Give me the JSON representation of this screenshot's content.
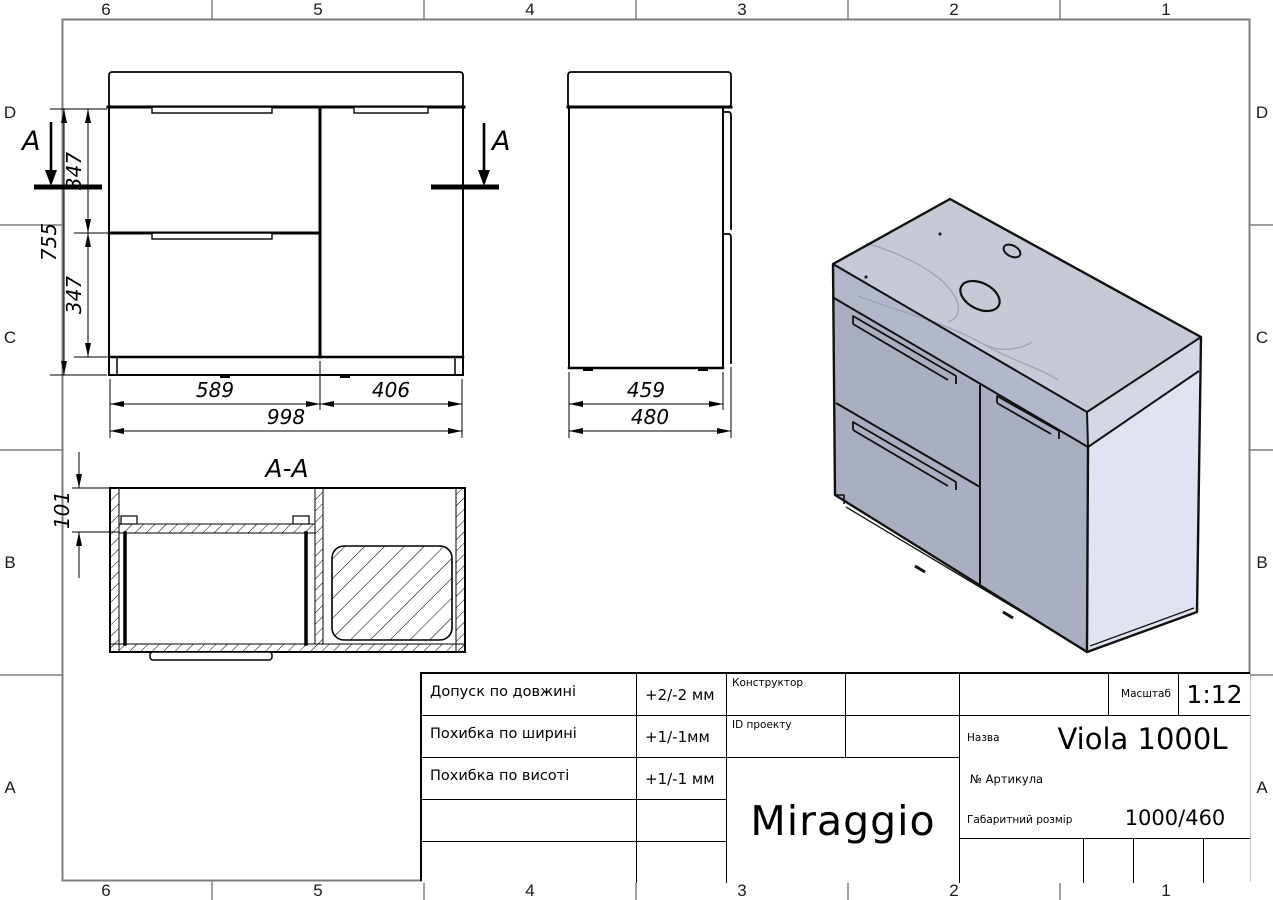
{
  "frame": {
    "columns": [
      "6",
      "5",
      "4",
      "3",
      "2",
      "1"
    ],
    "rows": [
      "D",
      "C",
      "B",
      "A"
    ]
  },
  "front_view": {
    "section_letter": "A",
    "dims": {
      "total_height": "755",
      "upper_drawer": "347",
      "lower_drawer": "347",
      "left_width": "589",
      "right_width": "406",
      "total_width": "998"
    }
  },
  "side_view": {
    "dims": {
      "body_depth": "459",
      "total_depth": "480"
    }
  },
  "section_view": {
    "title": "A-A",
    "dims": {
      "front_inset": "101"
    }
  },
  "title_block": {
    "tolerances": [
      {
        "label": "Допуск по довжині",
        "value": "+2/-2 мм"
      },
      {
        "label": "Похибка по ширині",
        "value": "+1/-1мм"
      },
      {
        "label": "Похибка по висоті",
        "value": "+1/-1 мм"
      }
    ],
    "constructor_label": "Конструктор",
    "project_id_label": "ID проекту",
    "brand": "Miraggio",
    "scale_label": "Масштаб",
    "scale_value": "1:12",
    "name_label": "Назва",
    "name_value": "Viola 1000L",
    "article_label": "№  Артикула",
    "overall_label": "Габаритний розмір",
    "overall_value": "1000/460"
  },
  "colors": {
    "line": "#000000",
    "frame_line": "#7d7d7d",
    "iso_top": "#c6cad7",
    "iso_deck_front": "#b2b7c9",
    "iso_deck_side": "#d4d8e6",
    "iso_front": "#a9afc1",
    "iso_side": "#e0e3f1",
    "iso_outline": "#111111"
  }
}
